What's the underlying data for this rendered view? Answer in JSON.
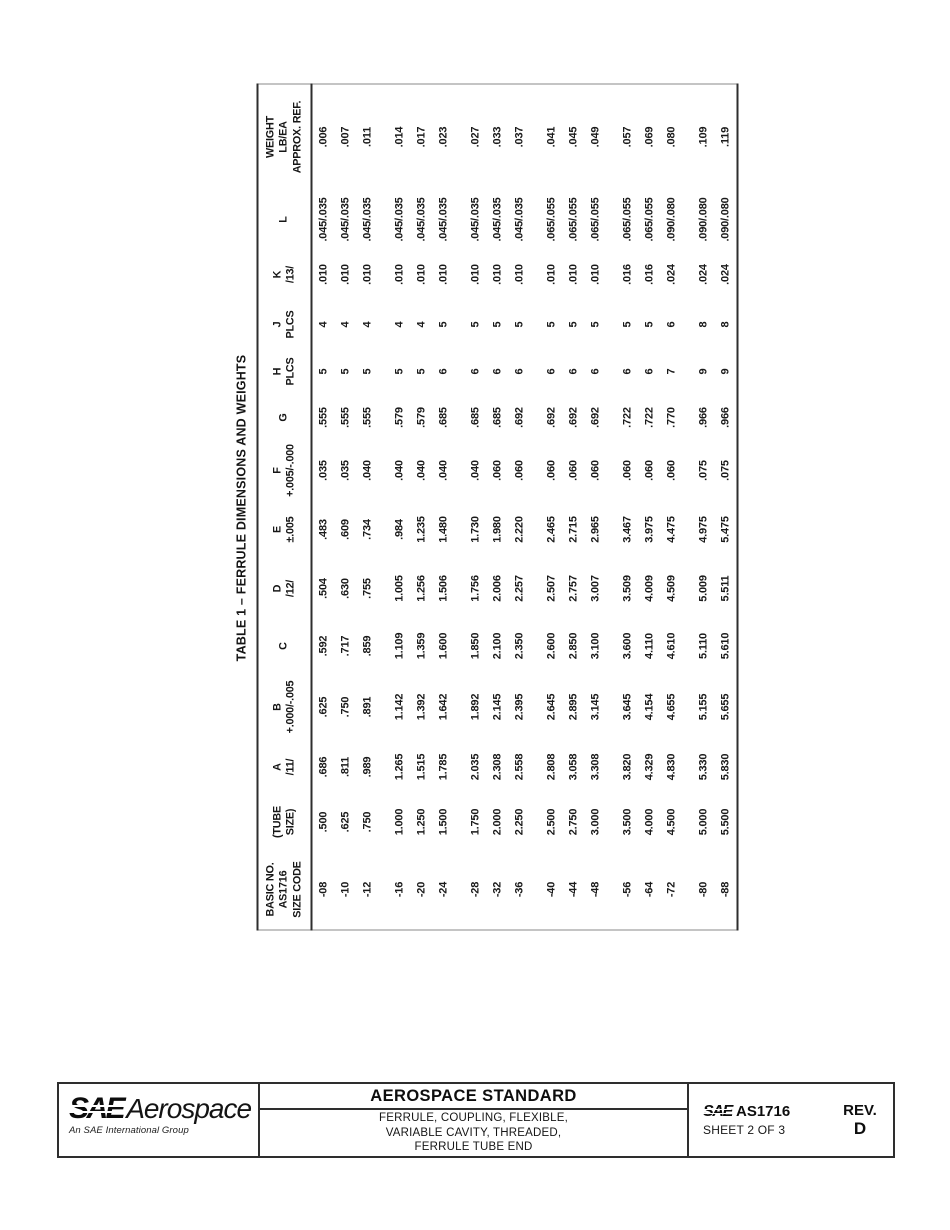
{
  "table": {
    "title": "TABLE 1 – FERRULE DIMENSIONS AND WEIGHTS",
    "columns": [
      {
        "name": "size-code",
        "label_lines": [
          "BASIC NO.",
          "AS1716",
          "SIZE CODE"
        ]
      },
      {
        "name": "tube-size",
        "label_lines": [
          "(TUBE",
          "SIZE)"
        ]
      },
      {
        "name": "a",
        "label_lines": [
          "A",
          "/11/"
        ]
      },
      {
        "name": "b",
        "label_lines": [
          "B",
          "+.000/-.005"
        ]
      },
      {
        "name": "c",
        "label_lines": [
          "C"
        ]
      },
      {
        "name": "d",
        "label_lines": [
          "D",
          "/12/"
        ]
      },
      {
        "name": "e",
        "label_lines": [
          "E",
          "±.005"
        ]
      },
      {
        "name": "f",
        "label_lines": [
          "F",
          "+.005/-.000"
        ]
      },
      {
        "name": "g",
        "label_lines": [
          "G"
        ]
      },
      {
        "name": "h",
        "label_lines": [
          "H",
          "PLCS"
        ]
      },
      {
        "name": "j",
        "label_lines": [
          "J",
          "PLCS"
        ]
      },
      {
        "name": "k",
        "label_lines": [
          "K",
          "/13/"
        ]
      },
      {
        "name": "l",
        "label_lines": [
          "L"
        ]
      },
      {
        "name": "weight",
        "label_lines": [
          "WEIGHT",
          "LB/EA",
          "APPROX. REF."
        ]
      }
    ],
    "groups": [
      {
        "rows": [
          [
            "-08",
            ".500",
            ".686",
            ".625",
            ".592",
            ".504",
            ".483",
            ".035",
            ".555",
            "5",
            "4",
            ".010",
            ".045/.035",
            ".006"
          ],
          [
            "-10",
            ".625",
            ".811",
            ".750",
            ".717",
            ".630",
            ".609",
            ".035",
            ".555",
            "5",
            "4",
            ".010",
            ".045/.035",
            ".007"
          ],
          [
            "-12",
            ".750",
            ".989",
            ".891",
            ".859",
            ".755",
            ".734",
            ".040",
            ".555",
            "5",
            "4",
            ".010",
            ".045/.035",
            ".011"
          ]
        ]
      },
      {
        "rows": [
          [
            "-16",
            "1.000",
            "1.265",
            "1.142",
            "1.109",
            "1.005",
            ".984",
            ".040",
            ".579",
            "5",
            "4",
            ".010",
            ".045/.035",
            ".014"
          ],
          [
            "-20",
            "1.250",
            "1.515",
            "1.392",
            "1.359",
            "1.256",
            "1.235",
            ".040",
            ".579",
            "5",
            "4",
            ".010",
            ".045/.035",
            ".017"
          ],
          [
            "-24",
            "1.500",
            "1.785",
            "1.642",
            "1.600",
            "1.506",
            "1.480",
            ".040",
            ".685",
            "6",
            "5",
            ".010",
            ".045/.035",
            ".023"
          ]
        ]
      },
      {
        "rows": [
          [
            "-28",
            "1.750",
            "2.035",
            "1.892",
            "1.850",
            "1.756",
            "1.730",
            ".040",
            ".685",
            "6",
            "5",
            ".010",
            ".045/.035",
            ".027"
          ],
          [
            "-32",
            "2.000",
            "2.308",
            "2.145",
            "2.100",
            "2.006",
            "1.980",
            ".060",
            ".685",
            "6",
            "5",
            ".010",
            ".045/.035",
            ".033"
          ],
          [
            "-36",
            "2.250",
            "2.558",
            "2.395",
            "2.350",
            "2.257",
            "2.220",
            ".060",
            ".692",
            "6",
            "5",
            ".010",
            ".045/.035",
            ".037"
          ]
        ]
      },
      {
        "rows": [
          [
            "-40",
            "2.500",
            "2.808",
            "2.645",
            "2.600",
            "2.507",
            "2.465",
            ".060",
            ".692",
            "6",
            "5",
            ".010",
            ".065/.055",
            ".041"
          ],
          [
            "-44",
            "2.750",
            "3.058",
            "2.895",
            "2.850",
            "2.757",
            "2.715",
            ".060",
            ".692",
            "6",
            "5",
            ".010",
            ".065/.055",
            ".045"
          ],
          [
            "-48",
            "3.000",
            "3.308",
            "3.145",
            "3.100",
            "3.007",
            "2.965",
            ".060",
            ".692",
            "6",
            "5",
            ".010",
            ".065/.055",
            ".049"
          ]
        ]
      },
      {
        "rows": [
          [
            "-56",
            "3.500",
            "3.820",
            "3.645",
            "3.600",
            "3.509",
            "3.467",
            ".060",
            ".722",
            "6",
            "5",
            ".016",
            ".065/.055",
            ".057"
          ],
          [
            "-64",
            "4.000",
            "4.329",
            "4.154",
            "4.110",
            "4.009",
            "3.975",
            ".060",
            ".722",
            "6",
            "5",
            ".016",
            ".065/.055",
            ".069"
          ],
          [
            "-72",
            "4.500",
            "4.830",
            "4.655",
            "4.610",
            "4.509",
            "4.475",
            ".060",
            ".770",
            "7",
            "6",
            ".024",
            ".090/.080",
            ".080"
          ]
        ]
      },
      {
        "rows": [
          [
            "-80",
            "5.000",
            "5.330",
            "5.155",
            "5.110",
            "5.009",
            "4.975",
            ".075",
            ".966",
            "9",
            "8",
            ".024",
            ".090/.080",
            ".109"
          ],
          [
            "-88",
            "5.500",
            "5.830",
            "5.655",
            "5.610",
            "5.511",
            "5.475",
            ".075",
            ".966",
            "9",
            "8",
            ".024",
            ".090/.080",
            ".119"
          ]
        ]
      }
    ]
  },
  "footer": {
    "logo": {
      "sae": "SAE",
      "brand": "Aerospace",
      "tagline": "An SAE International Group"
    },
    "doc_type": "AEROSPACE STANDARD",
    "doc_title_lines": [
      "FERRULE, COUPLING, FLEXIBLE,",
      "VARIABLE CAVITY, THREADED,",
      "FERRULE TUBE END"
    ],
    "standard": {
      "sae": "SAE",
      "number": "AS1716",
      "sheet": "SHEET 2 OF 3"
    },
    "rev": {
      "label": "REV.",
      "value": "D"
    }
  }
}
